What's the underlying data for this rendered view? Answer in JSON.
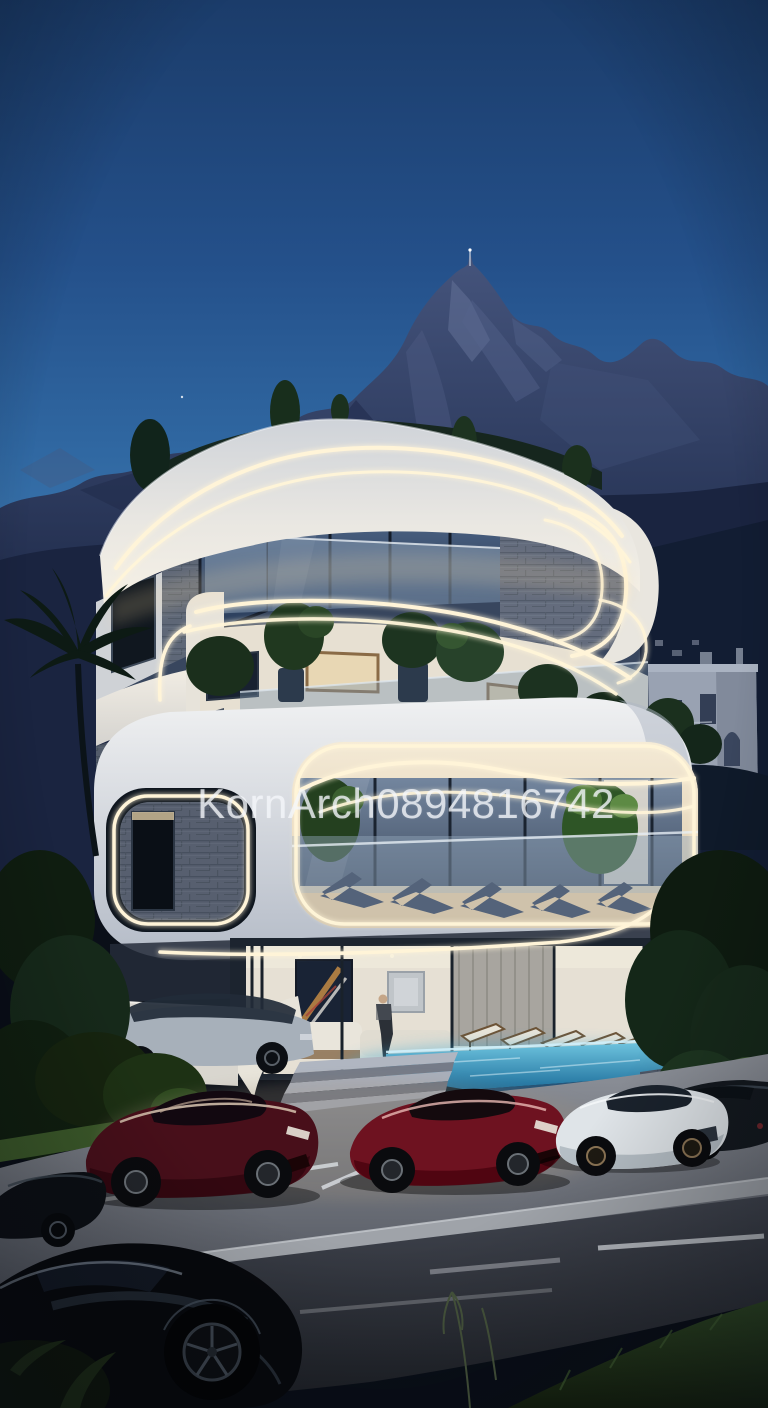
{
  "watermark": {
    "text": "KornArch0894816742"
  },
  "scene": {
    "setting": "Futuristic curved white villa with warm LED strip lighting at dusk, mountain backdrop, rooftop garden, infinity pool and luxury sports cars parked in front",
    "time_of_day": "dusk",
    "floors_visible": 4,
    "person_count": 1,
    "cars": [
      {
        "position": "foreground-left",
        "color": "black"
      },
      {
        "position": "parked-left-edge",
        "color": "black"
      },
      {
        "position": "stall-1",
        "color": "dark-red"
      },
      {
        "position": "stall-2",
        "color": "red"
      },
      {
        "position": "stall-3",
        "color": "white"
      },
      {
        "position": "stall-4",
        "color": "black"
      },
      {
        "position": "driveway",
        "color": "silver-suv"
      }
    ]
  },
  "palette": {
    "sky_top": "#1b3c6a",
    "sky_horizon": "#3d77ae",
    "mountain": "#36456a",
    "building_white": "#efeade",
    "led_warm": "#fff4d8",
    "glass": "#3c506e",
    "pool_water": "#2f8fbe",
    "pavement": "#82868f",
    "asphalt": "#2b2e36",
    "vegetation": "#1c2f1b"
  }
}
